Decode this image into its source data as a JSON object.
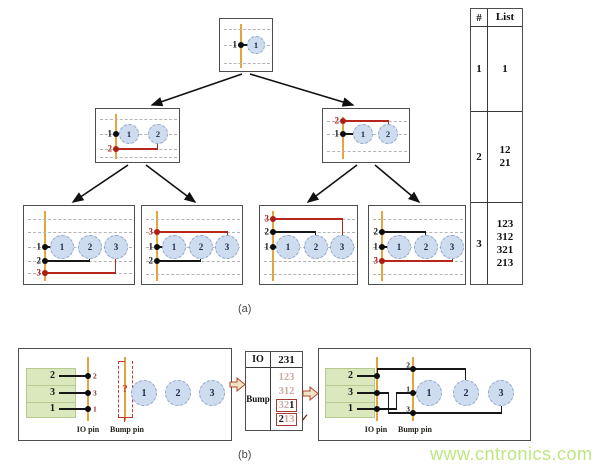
{
  "section_a": {
    "caption": "(a)",
    "root": {
      "pins": [
        "1"
      ],
      "circles": [
        "1"
      ]
    },
    "node12": {
      "pins": [
        "1",
        "2"
      ],
      "circles": [
        "1",
        "2"
      ]
    },
    "node21": {
      "pins": [
        "2",
        "1"
      ],
      "circles": [
        "1",
        "2"
      ]
    },
    "leaf123": {
      "pins": [
        "1",
        "2",
        "3"
      ],
      "circles": [
        "1",
        "2",
        "3"
      ]
    },
    "leaf312": {
      "pins": [
        "3",
        "1",
        "2"
      ],
      "circles": [
        "1",
        "2",
        "3"
      ]
    },
    "leaf321": {
      "pins": [
        "3",
        "2",
        "1"
      ],
      "circles": [
        "1",
        "2",
        "3"
      ]
    },
    "leaf213": {
      "pins": [
        "2",
        "1",
        "3"
      ],
      "circles": [
        "1",
        "2",
        "3"
      ]
    },
    "table": {
      "headers": [
        "#",
        "List"
      ],
      "rows": [
        {
          "count": "1",
          "items": [
            "1"
          ]
        },
        {
          "count": "2",
          "items": [
            "12",
            "21"
          ]
        },
        {
          "count": "3",
          "items": [
            "123",
            "312",
            "321",
            "213"
          ]
        }
      ]
    }
  },
  "section_b": {
    "caption": "(b)",
    "left_die": {
      "io_rows": [
        "2",
        "3",
        "1"
      ],
      "io_dot_labels": [
        "2",
        "3",
        "1"
      ],
      "question_mark": "?",
      "circles": [
        "1",
        "2",
        "3"
      ],
      "io_pin_caption": "IO pin",
      "bump_pin_caption": "Bump pin"
    },
    "io_table": {
      "header_io": "IO",
      "header_value": "231",
      "row_label": "Bump",
      "options": [
        "123",
        "312",
        "321",
        "213"
      ],
      "option3_dim": "32",
      "option3_bold": "1",
      "option4_bold": "2",
      "option4_dim": "13",
      "checkmark": "✓"
    },
    "right_die": {
      "io_rows": [
        "2",
        "3",
        "1"
      ],
      "bump_dot_labels": [
        "2",
        "1",
        "3"
      ],
      "circles": [
        "1",
        "2",
        "3"
      ],
      "io_pin_caption": "IO pin",
      "bump_pin_caption": "Bump pin"
    }
  },
  "watermark": "www.cntronics.com"
}
